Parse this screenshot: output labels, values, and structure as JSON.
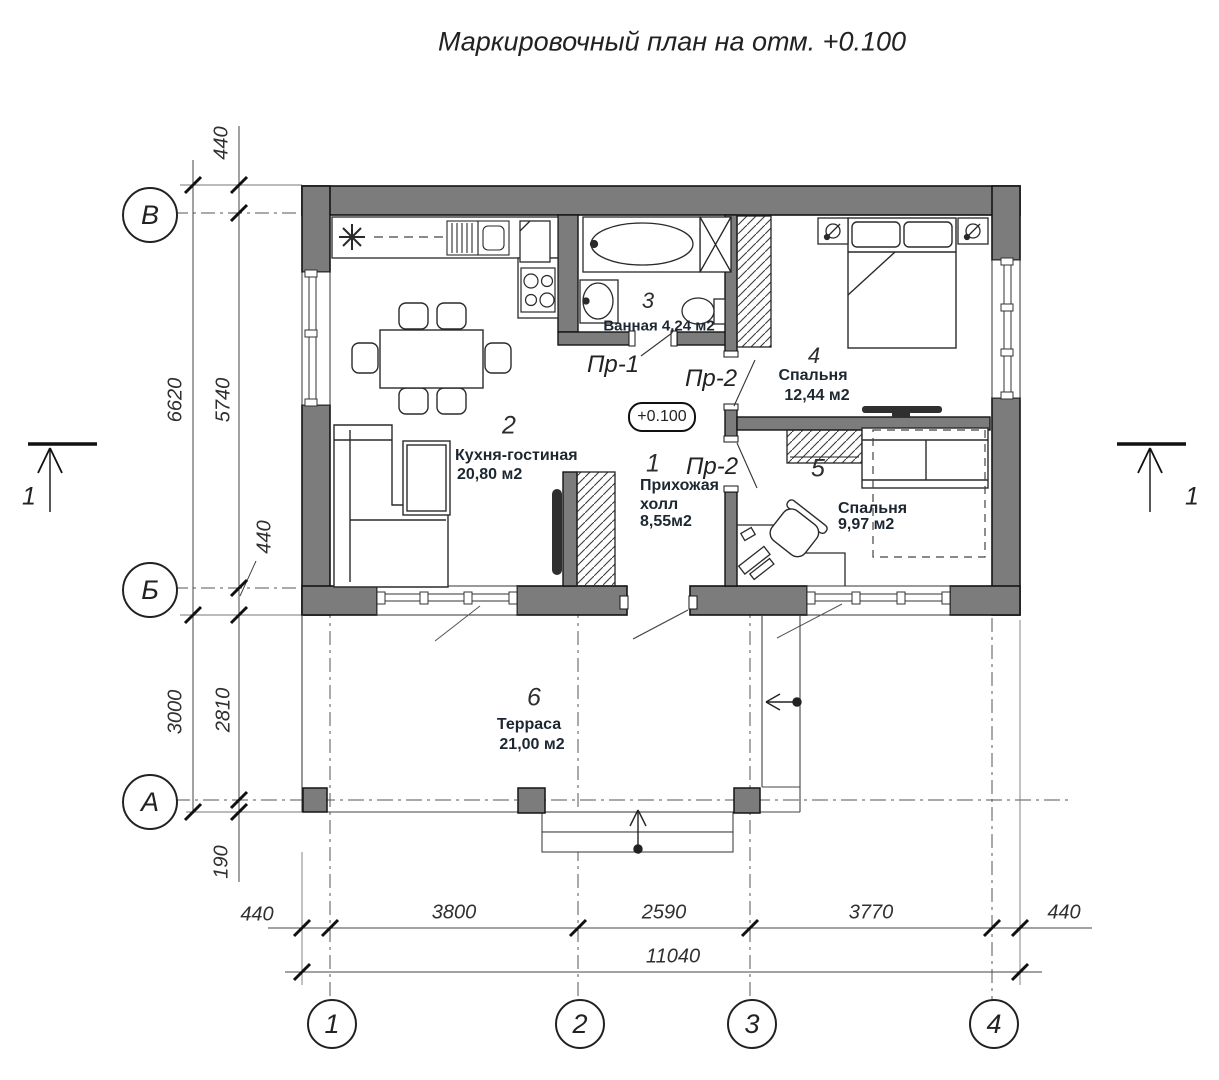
{
  "title": "Маркировочный план на отм. +0.100",
  "elevation_mark": "+0.100",
  "axes": {
    "horizontal": [
      "В",
      "Б",
      "А"
    ],
    "vertical": [
      "1",
      "2",
      "3",
      "4"
    ]
  },
  "dims": {
    "left": {
      "w440_top": "440",
      "h6620": "6620",
      "h5740": "5740",
      "w440_inner": "440",
      "h3000": "3000",
      "h2810": "2810",
      "h190": "190"
    },
    "bottom": {
      "w440_left": "440",
      "w3800": "3800",
      "w2590": "2590",
      "w3770": "3770",
      "w440_right": "440",
      "total": "11040"
    }
  },
  "rooms": [
    {
      "number": "1",
      "line1": "Прихожая",
      "line2": "холл",
      "area": "8,55м2"
    },
    {
      "number": "2",
      "name": "Кухня-гостиная",
      "area": "20,80 м2"
    },
    {
      "number": "3",
      "label": "Ванная 4,24 м2"
    },
    {
      "number": "4",
      "name": "Спальня",
      "area": "12,44 м2"
    },
    {
      "number": "5",
      "name": "Спальня",
      "area": "9,97 м2"
    },
    {
      "number": "6",
      "name": "Терраса",
      "area": "21,00 м2"
    }
  ],
  "openings": {
    "pr1": "Пр-1",
    "pr2a": "Пр-2",
    "pr2b": "Пр-2"
  },
  "section_marks": {
    "left": "1",
    "right": "1"
  },
  "colors": {
    "wall_fill": "#7c7c7c",
    "line": "#1a1a1a"
  }
}
